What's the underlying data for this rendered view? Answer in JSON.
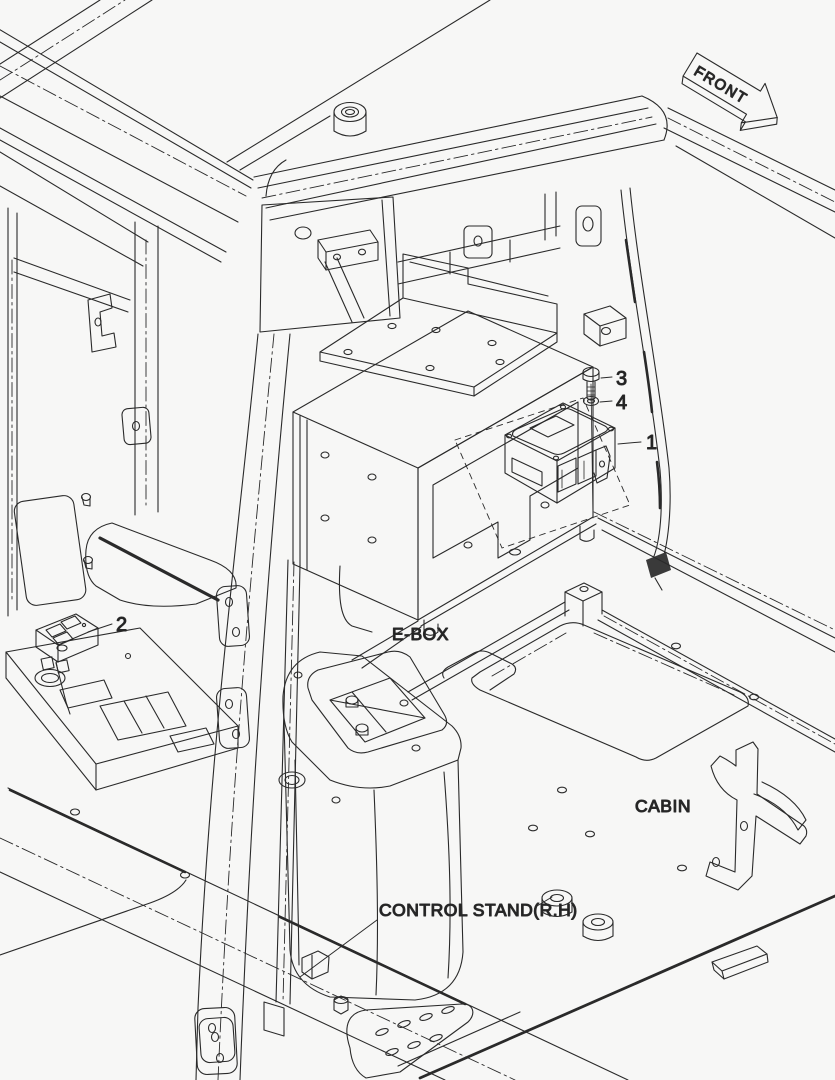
{
  "diagram": {
    "title": "cabin electronic box installation drawing",
    "background_color": "#f7f7f6",
    "line_color": "#2a2a2a",
    "front_arrow": {
      "label": "FRONT"
    },
    "labels": {
      "ebox": "E-BOX",
      "cabin": "CABIN",
      "control_stand": "CONTROL STAND(R.H)"
    },
    "callouts": [
      {
        "number": "1",
        "points_to": "controller-unit"
      },
      {
        "number": "2",
        "points_to": "switch-panel"
      },
      {
        "number": "3",
        "points_to": "screw"
      },
      {
        "number": "4",
        "points_to": "washer"
      }
    ]
  }
}
